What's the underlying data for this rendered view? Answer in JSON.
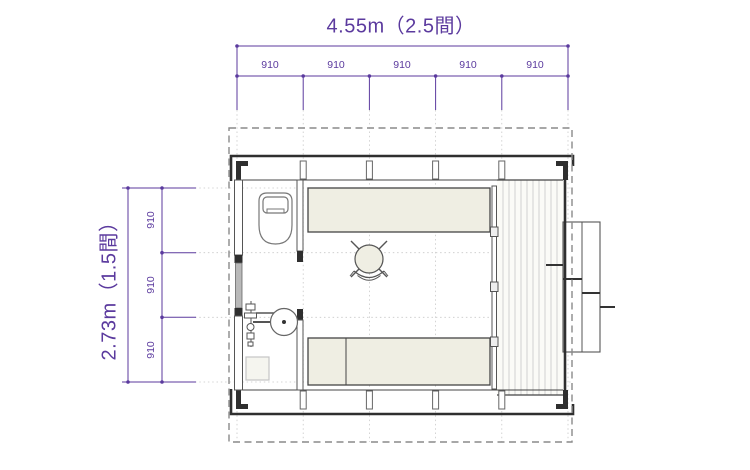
{
  "colors": {
    "accent": "#5b3a9e",
    "wall": "#2f2f2f",
    "line": "#555555",
    "furniture-fill": "#efeee3",
    "deck-plank": "#cdcdcd",
    "dash": "#8a8a8a",
    "grid": "#c9c9c9",
    "window-fill": "#b9b9b9",
    "background": "#ffffff"
  },
  "dimensions": {
    "top": {
      "overall": "4.55m（2.5間）",
      "segments": [
        "910",
        "910",
        "910",
        "910",
        "910"
      ]
    },
    "left": {
      "overall": "2.73m（1.5間）",
      "segments": [
        "910",
        "910",
        "910"
      ]
    }
  },
  "plan": {
    "fixtures": [
      "toilet",
      "washbasin",
      "floor-drain-pan",
      "counter",
      "round-table",
      "chair",
      "bed",
      "sliding-door",
      "window",
      "deck",
      "steps",
      "eave-outline"
    ]
  }
}
